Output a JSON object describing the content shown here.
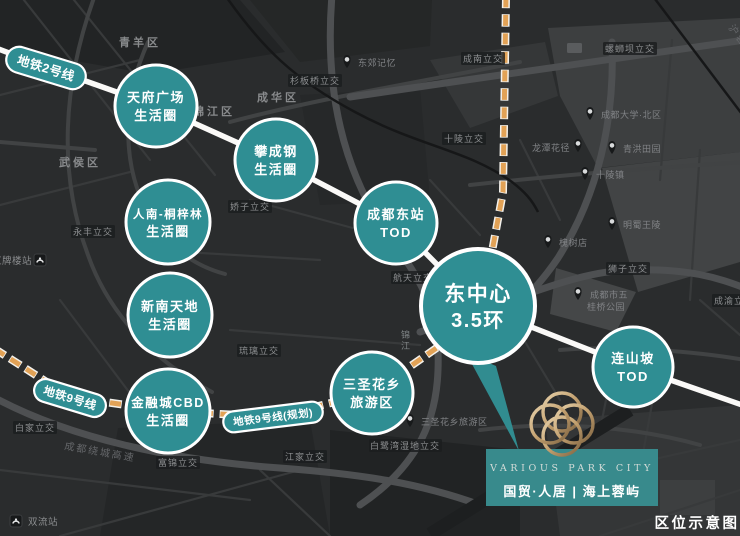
{
  "caption": "区位示意图",
  "metro_badges": {
    "line2": "地铁2号线",
    "line9": "地铁9号线",
    "line9_planned": "地铁9号线(规划)"
  },
  "nodes": [
    {
      "line1": "天府广场",
      "line2": "生活圈"
    },
    {
      "line1": "攀成钢",
      "line2": "生活圈"
    },
    {
      "line1": "人南-桐梓林",
      "line2": "生活圈"
    },
    {
      "line1": "新南天地",
      "line2": "生活圈"
    },
    {
      "line1": "金融城CBD",
      "line2": "生活圈"
    },
    {
      "line1": "成都东站",
      "line2": "TOD"
    },
    {
      "line1": "东中心",
      "line2": "3.5环"
    },
    {
      "line1": "三圣花乡",
      "line2": "旅游区"
    },
    {
      "line1": "连山坡",
      "line2": "TOD"
    }
  ],
  "districts": [
    "青羊区",
    "成华区",
    "锦江区",
    "武侯区"
  ],
  "river": "锦江",
  "interchanges": [
    "永丰立交",
    "杉板桥立交",
    "成南立交",
    "十陵立交",
    "螺蛳坝立交",
    "狮子立交",
    "航天立交",
    "娇子立交",
    "白家立交",
    "琉璃立交",
    "江家立交",
    "白鹭湾湿地立交",
    "富锦立交",
    "成渝立交"
  ],
  "stations": [
    "红牌楼站",
    "双流站"
  ],
  "pois": [
    {
      "label": "东郊记忆"
    },
    {
      "label": "成都大学·北区"
    },
    {
      "label": "青洪田园"
    },
    {
      "label": "龙潭花径"
    },
    {
      "label": "三圣花乡旅游区"
    },
    {
      "label": "十陵镇"
    },
    {
      "label": "明蜀王陵"
    },
    {
      "label": "槐树店"
    },
    {
      "label": "成都市五",
      "label2": "桂桥公园"
    }
  ],
  "road_labels": [
    "成都绕城高速",
    "沪蓉高速"
  ],
  "brand": {
    "name_en": "VARIOUS PARK CITY",
    "name_cn": "国贸·人居 | 海上蓉屿"
  },
  "colors": {
    "map_bg": "#2a2c2d",
    "node_teal": "#2f8e93",
    "logo_box_teal": "#388a8c",
    "dash_orange": "#e2a256",
    "metro_white": "#faf9f7",
    "logo_gold": "#c8a97d"
  }
}
